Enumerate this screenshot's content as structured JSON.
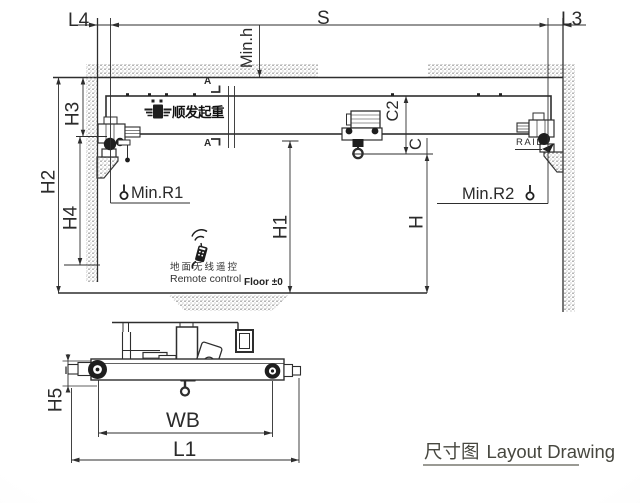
{
  "page": {
    "title_cn": "尺寸图",
    "title_en": "Layout Drawing"
  },
  "brand": {
    "logo_text": "顺发起重"
  },
  "annotations": {
    "rail": "RAIL",
    "floor": "Floor ±0",
    "remote_cn": "地面无线遥控",
    "remote_en": "Remote control",
    "section_mark": "A"
  },
  "dimensions": {
    "l4": "L4",
    "s": "S",
    "l3": "L3",
    "min_h": "Min.h",
    "h3": "H3",
    "h2": "H2",
    "h4": "H4",
    "h1": "H1",
    "h": "H",
    "c2": "C2",
    "c": "C",
    "min_r1": "Min.R1",
    "min_r2": "Min.R2",
    "h5": "H5",
    "wb": "WB",
    "l1": "L1"
  },
  "colors": {
    "line": "#2e2e2e",
    "text": "#2b2b2b",
    "title_text": "#47473f",
    "background": "#ffffff"
  }
}
